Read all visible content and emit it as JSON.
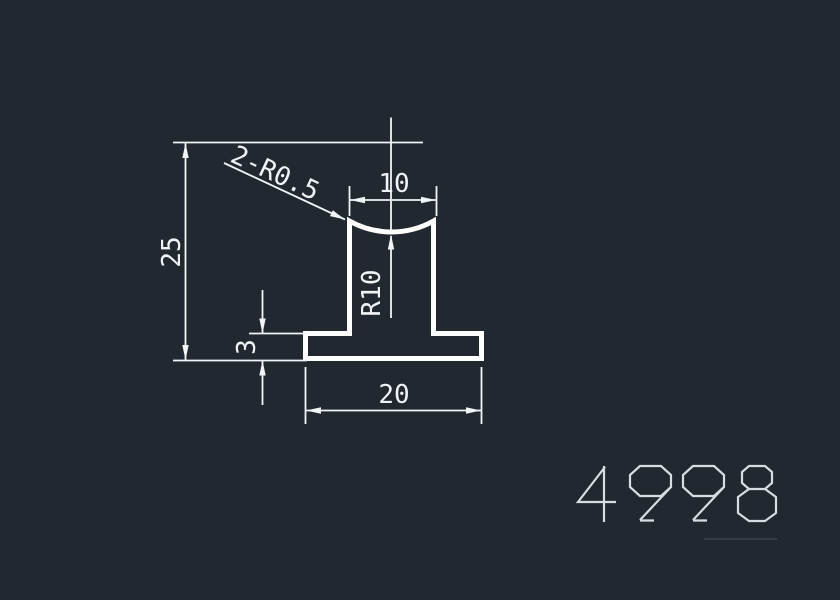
{
  "app": {
    "view": "cad-drawing-preview",
    "background_color": "#212830"
  },
  "drawing": {
    "part_number": "4998",
    "labels": {
      "overall_height": "25",
      "top_width": "10",
      "base_width": "20",
      "base_thickness": "3",
      "concave_radius": "R10",
      "corner_radii_note": "2-R0.5"
    },
    "colors": {
      "outline": "#ffffff",
      "dimension_lines": "#f2f5f7",
      "dimension_text": "#f0f3f5",
      "part_number_text": "#d8dde2",
      "faint_rule": "#3b424c"
    }
  }
}
